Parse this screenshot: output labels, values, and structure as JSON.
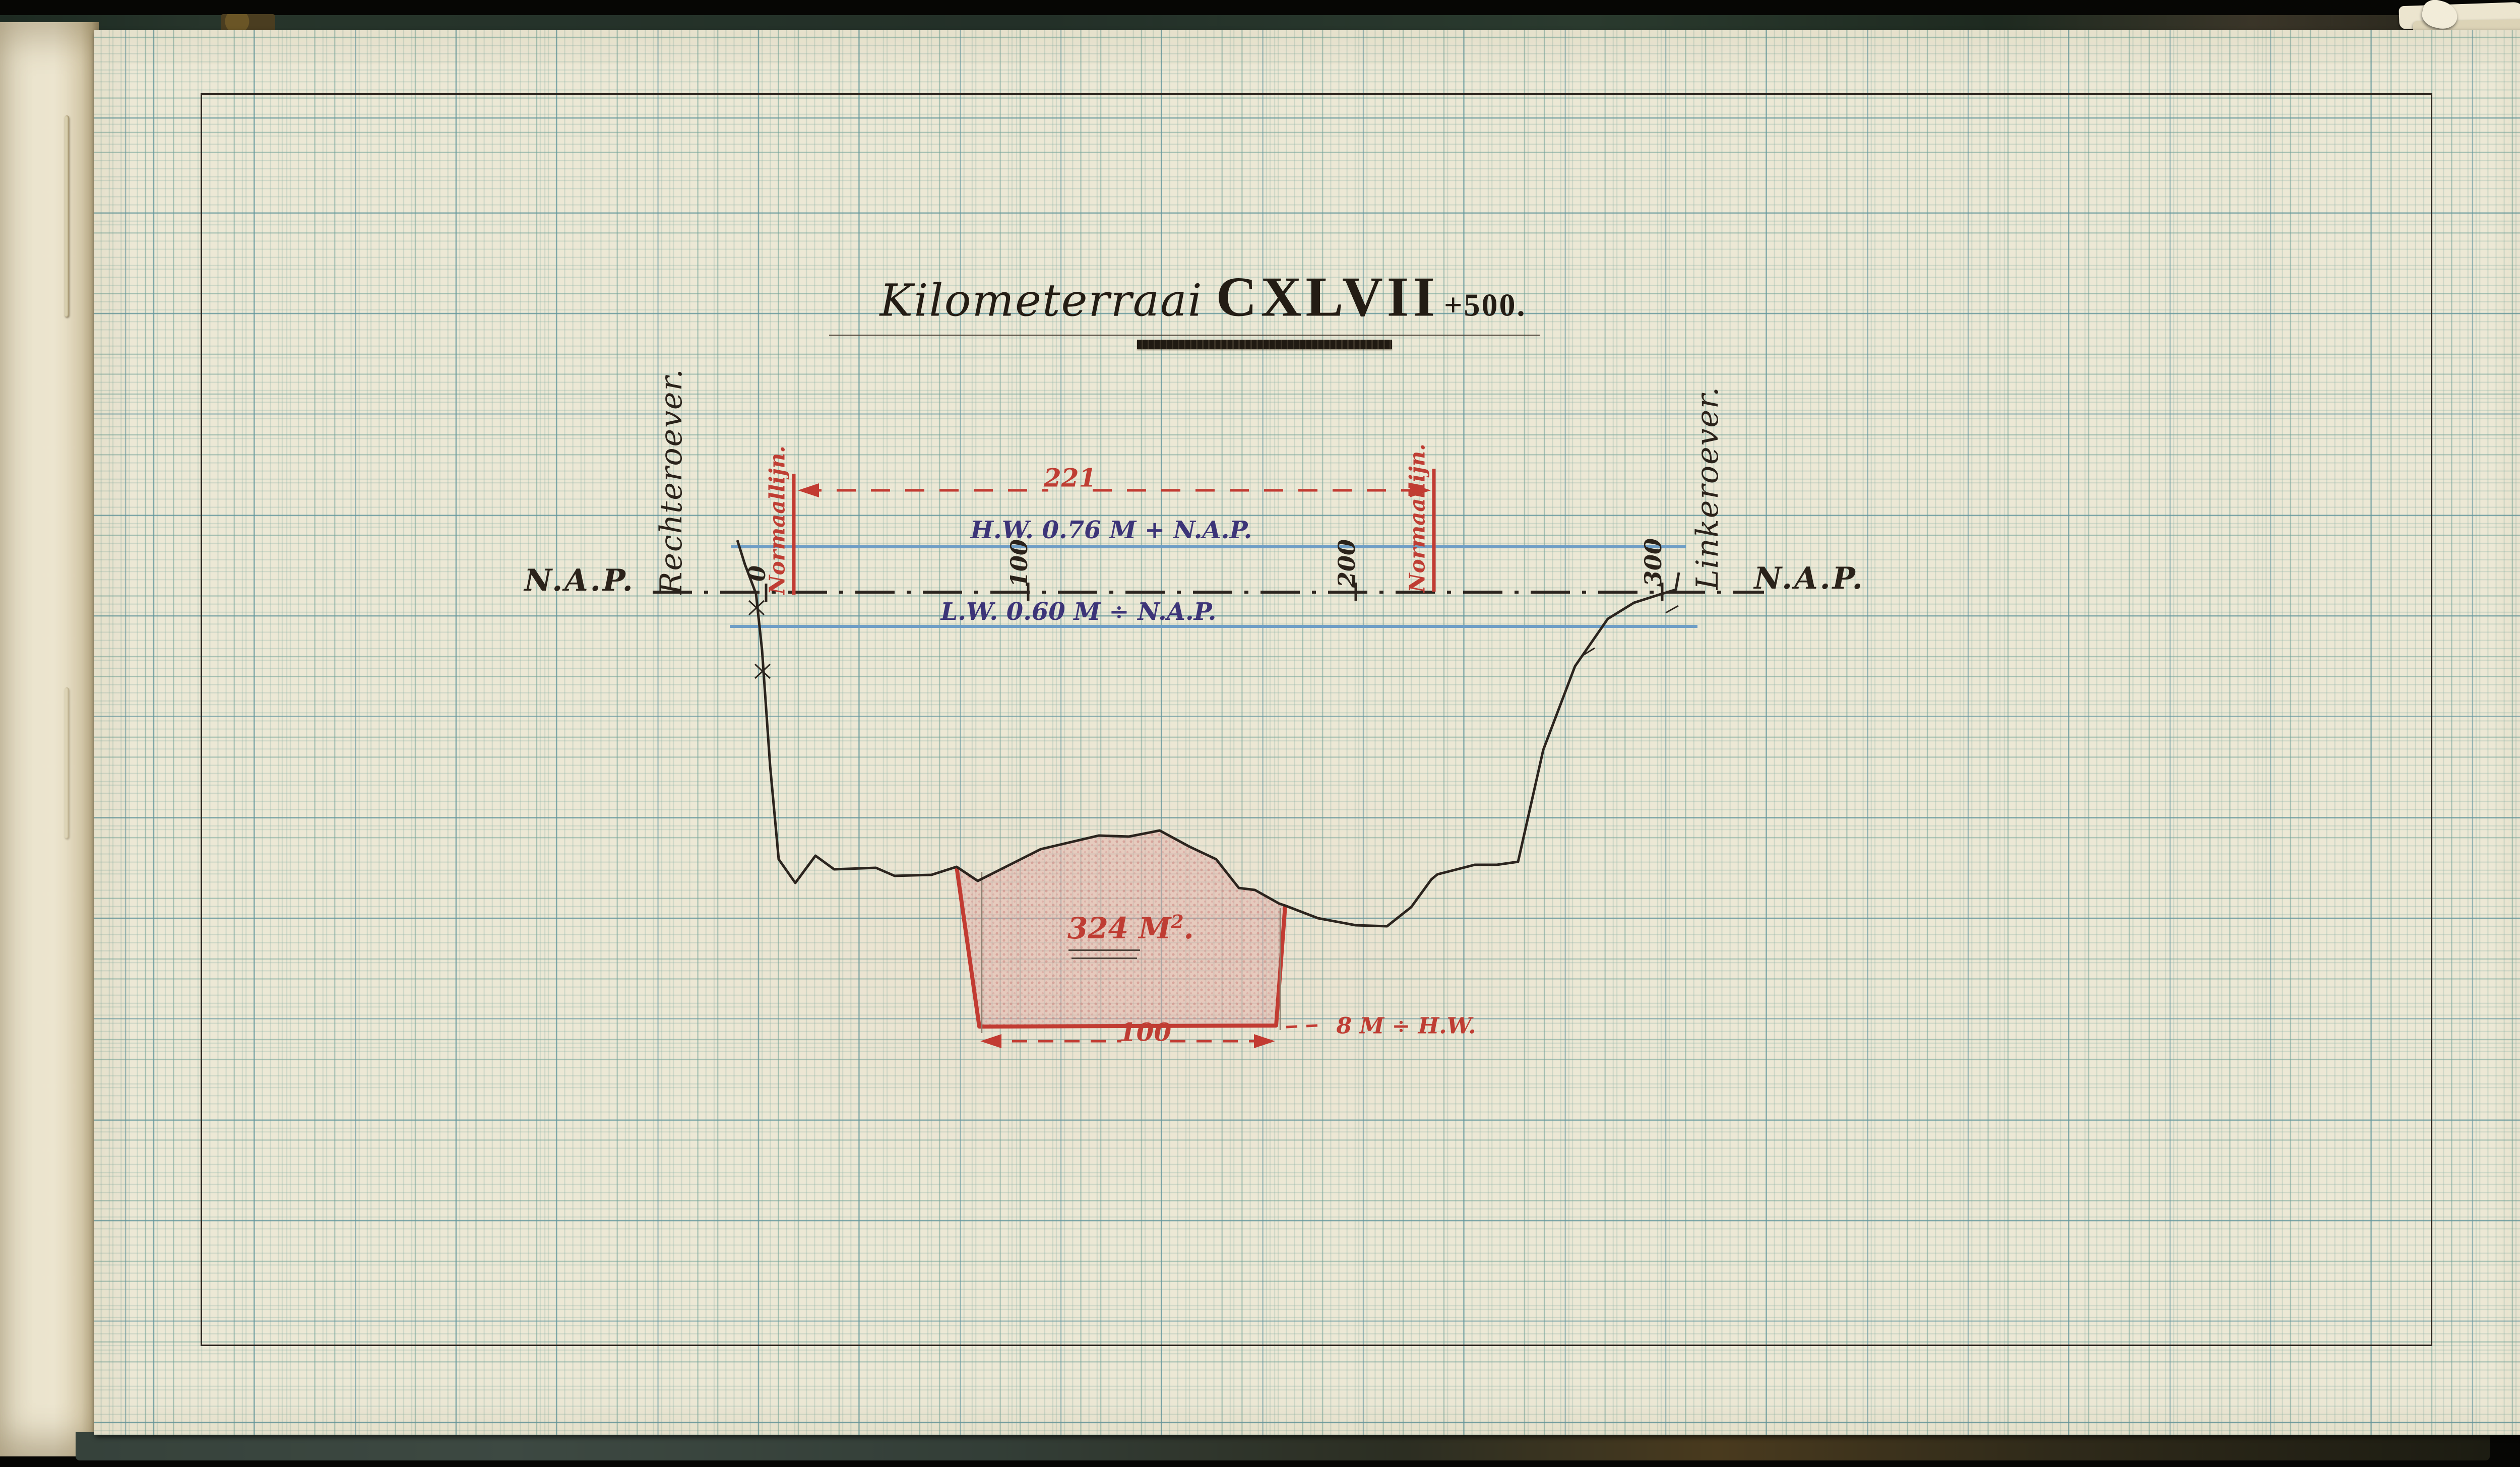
{
  "title": {
    "script": "Kilometerraai",
    "roman": "CXLVII",
    "suffix": "+500."
  },
  "labels": {
    "nap": "N.A.P.",
    "bank_left_of_drawing": "Rechteroever.",
    "bank_right_of_drawing": "Linkeroever.",
    "normal_line": "Normaallijn.",
    "high_water": "H.W. 0.76 M + N.A.P.",
    "low_water": "L.W. 0.60 M ÷ N.A.P."
  },
  "dimensions": {
    "normal_width": "221",
    "bottom_width": "100",
    "depth_below_hw": "8 M ÷ H.W."
  },
  "area": {
    "value": "324",
    "unit": "M",
    "sup": "2",
    "dot": "."
  },
  "datum_ticks": [
    "0",
    "100",
    "200",
    "300"
  ],
  "colors": {
    "paper": "#ece8d5",
    "grid_minor": "#80aaa0",
    "grid_major": "#60949e",
    "ink_black": "#2a221a",
    "ink_red": "#bf3d33",
    "ink_indigo": "#3c3478",
    "water_line_blue": "#6f9ec6",
    "profile_fill_pink": "#e3b4b0",
    "cover_green": "#27352b",
    "cover_marble": "#3a3b24"
  }
}
